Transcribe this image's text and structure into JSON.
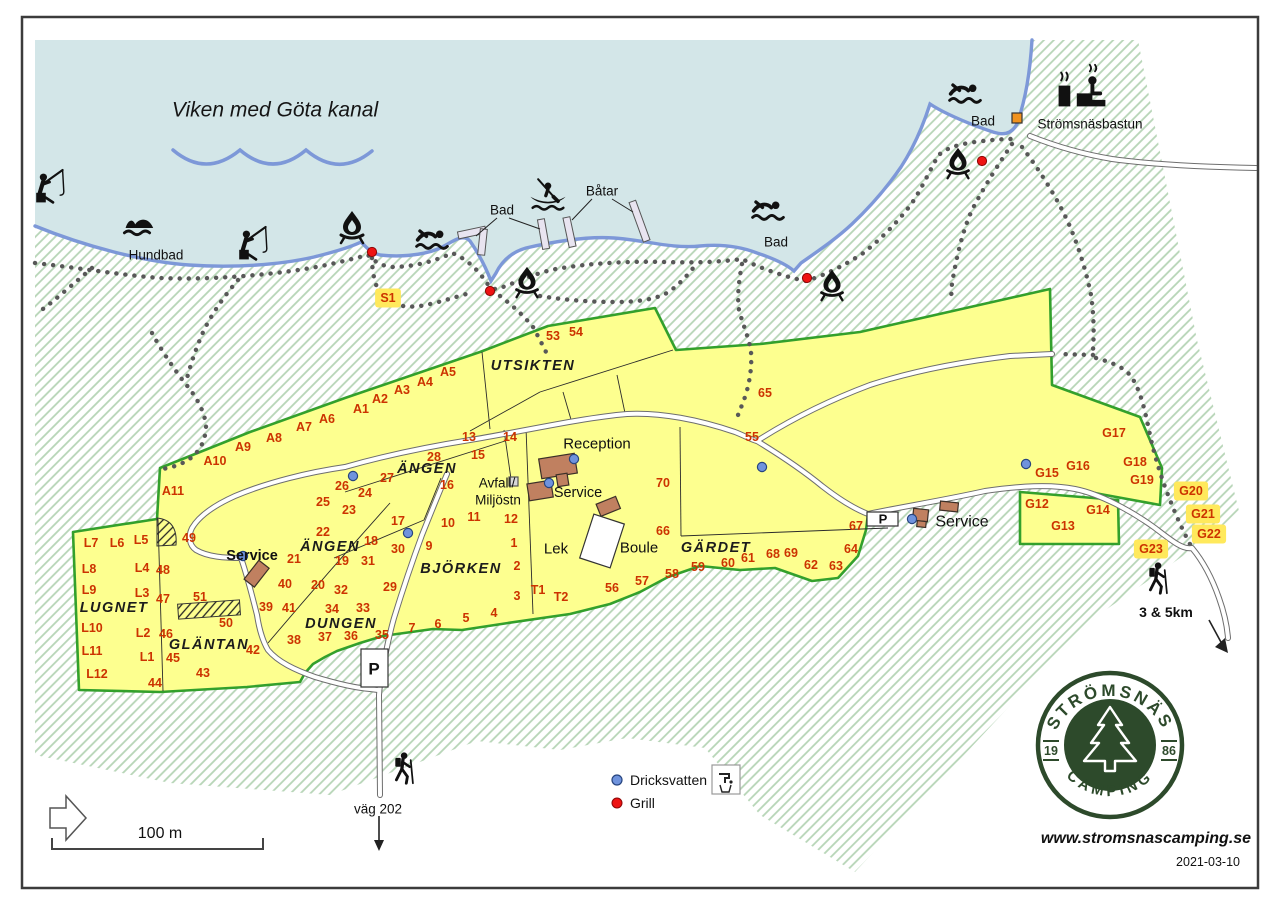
{
  "water": {
    "label": "Viken med Göta kanal"
  },
  "legend": {
    "drinking_water": "Dricksvatten",
    "grill": "Grill"
  },
  "footer": {
    "website": "www.stromsnascamping.se",
    "date": "2021-03-10",
    "scale_label": "100 m"
  },
  "logo": {
    "top": "STRÖMSNÄS",
    "bottom": "CAMPING",
    "year_left": "19",
    "year_right": "86"
  },
  "colors": {
    "water": "#d3e6e8",
    "shoreline": "#7d98d8",
    "camp_yellow": "#fdff8f",
    "camp_border": "#33a02c",
    "site_number": "#cc3300",
    "highlight_bg": "#ffe95c",
    "building": "#c08060",
    "bastun_orange": "#f0921e",
    "drinking_water_dot": "#6f93dd",
    "grill_dot": "#ee1313",
    "logo_green": "#2d4a2b",
    "land_hatch": "#b7d5b7"
  },
  "labels": {
    "sites": [
      {
        "t": "1",
        "x": 514,
        "y": 543
      },
      {
        "t": "2",
        "x": 517,
        "y": 566
      },
      {
        "t": "3",
        "x": 517,
        "y": 596
      },
      {
        "t": "4",
        "x": 494,
        "y": 613
      },
      {
        "t": "5",
        "x": 466,
        "y": 618
      },
      {
        "t": "6",
        "x": 438,
        "y": 624
      },
      {
        "t": "7",
        "x": 412,
        "y": 628
      },
      {
        "t": "9",
        "x": 429,
        "y": 546
      },
      {
        "t": "10",
        "x": 448,
        "y": 523
      },
      {
        "t": "11",
        "x": 474,
        "y": 517
      },
      {
        "t": "12",
        "x": 511,
        "y": 519
      },
      {
        "t": "13",
        "x": 469,
        "y": 437
      },
      {
        "t": "14",
        "x": 510,
        "y": 437
      },
      {
        "t": "15",
        "x": 478,
        "y": 455
      },
      {
        "t": "16",
        "x": 447,
        "y": 485
      },
      {
        "t": "17",
        "x": 398,
        "y": 521
      },
      {
        "t": "18",
        "x": 371,
        "y": 541
      },
      {
        "t": "19",
        "x": 342,
        "y": 561
      },
      {
        "t": "20",
        "x": 318,
        "y": 585
      },
      {
        "t": "21",
        "x": 294,
        "y": 559
      },
      {
        "t": "22",
        "x": 323,
        "y": 532
      },
      {
        "t": "23",
        "x": 349,
        "y": 510
      },
      {
        "t": "24",
        "x": 365,
        "y": 493
      },
      {
        "t": "25",
        "x": 323,
        "y": 502
      },
      {
        "t": "26",
        "x": 342,
        "y": 486
      },
      {
        "t": "27",
        "x": 387,
        "y": 478
      },
      {
        "t": "28",
        "x": 434,
        "y": 457
      },
      {
        "t": "29",
        "x": 390,
        "y": 587
      },
      {
        "t": "30",
        "x": 398,
        "y": 549
      },
      {
        "t": "31",
        "x": 368,
        "y": 561
      },
      {
        "t": "32",
        "x": 341,
        "y": 590
      },
      {
        "t": "33",
        "x": 363,
        "y": 608
      },
      {
        "t": "34",
        "x": 332,
        "y": 609
      },
      {
        "t": "35",
        "x": 382,
        "y": 635
      },
      {
        "t": "36",
        "x": 351,
        "y": 636
      },
      {
        "t": "37",
        "x": 325,
        "y": 637
      },
      {
        "t": "38",
        "x": 294,
        "y": 640
      },
      {
        "t": "39",
        "x": 266,
        "y": 607
      },
      {
        "t": "40",
        "x": 285,
        "y": 584
      },
      {
        "t": "41",
        "x": 289,
        "y": 608
      },
      {
        "t": "42",
        "x": 253,
        "y": 650
      },
      {
        "t": "43",
        "x": 203,
        "y": 673
      },
      {
        "t": "44",
        "x": 155,
        "y": 683
      },
      {
        "t": "45",
        "x": 173,
        "y": 658
      },
      {
        "t": "46",
        "x": 166,
        "y": 634
      },
      {
        "t": "47",
        "x": 163,
        "y": 599
      },
      {
        "t": "48",
        "x": 163,
        "y": 570
      },
      {
        "t": "49",
        "x": 189,
        "y": 538
      },
      {
        "t": "50",
        "x": 226,
        "y": 623
      },
      {
        "t": "51",
        "x": 200,
        "y": 597
      },
      {
        "t": "53",
        "x": 553,
        "y": 336
      },
      {
        "t": "54",
        "x": 576,
        "y": 332
      },
      {
        "t": "55",
        "x": 752,
        "y": 437
      },
      {
        "t": "56",
        "x": 612,
        "y": 588
      },
      {
        "t": "57",
        "x": 642,
        "y": 581
      },
      {
        "t": "58",
        "x": 672,
        "y": 574
      },
      {
        "t": "59",
        "x": 698,
        "y": 567
      },
      {
        "t": "60",
        "x": 728,
        "y": 563
      },
      {
        "t": "61",
        "x": 748,
        "y": 558
      },
      {
        "t": "62",
        "x": 811,
        "y": 565
      },
      {
        "t": "63",
        "x": 836,
        "y": 566
      },
      {
        "t": "64",
        "x": 851,
        "y": 549
      },
      {
        "t": "65",
        "x": 765,
        "y": 393
      },
      {
        "t": "66",
        "x": 663,
        "y": 531
      },
      {
        "t": "67",
        "x": 856,
        "y": 526
      },
      {
        "t": "68",
        "x": 773,
        "y": 554
      },
      {
        "t": "69",
        "x": 791,
        "y": 553
      },
      {
        "t": "70",
        "x": 663,
        "y": 483
      },
      {
        "t": "A1",
        "x": 361,
        "y": 409
      },
      {
        "t": "A2",
        "x": 380,
        "y": 399
      },
      {
        "t": "A3",
        "x": 402,
        "y": 390
      },
      {
        "t": "A4",
        "x": 425,
        "y": 382
      },
      {
        "t": "A5",
        "x": 448,
        "y": 372
      },
      {
        "t": "A6",
        "x": 327,
        "y": 419
      },
      {
        "t": "A7",
        "x": 304,
        "y": 427
      },
      {
        "t": "A8",
        "x": 274,
        "y": 438
      },
      {
        "t": "A9",
        "x": 243,
        "y": 447
      },
      {
        "t": "A10",
        "x": 215,
        "y": 461
      },
      {
        "t": "A11",
        "x": 173,
        "y": 491
      },
      {
        "t": "L1",
        "x": 147,
        "y": 657
      },
      {
        "t": "L2",
        "x": 143,
        "y": 633
      },
      {
        "t": "L3",
        "x": 142,
        "y": 593
      },
      {
        "t": "L4",
        "x": 142,
        "y": 568
      },
      {
        "t": "L5",
        "x": 141,
        "y": 540
      },
      {
        "t": "L6",
        "x": 117,
        "y": 543
      },
      {
        "t": "L7",
        "x": 91,
        "y": 543
      },
      {
        "t": "L8",
        "x": 89,
        "y": 569
      },
      {
        "t": "L9",
        "x": 89,
        "y": 590
      },
      {
        "t": "L10",
        "x": 92,
        "y": 628
      },
      {
        "t": "L11",
        "x": 92,
        "y": 651
      },
      {
        "t": "L12",
        "x": 97,
        "y": 674
      },
      {
        "t": "G12",
        "x": 1037,
        "y": 504
      },
      {
        "t": "G13",
        "x": 1063,
        "y": 526
      },
      {
        "t": "G14",
        "x": 1098,
        "y": 510
      },
      {
        "t": "G15",
        "x": 1047,
        "y": 473
      },
      {
        "t": "G16",
        "x": 1078,
        "y": 466
      },
      {
        "t": "G17",
        "x": 1114,
        "y": 433
      },
      {
        "t": "G18",
        "x": 1135,
        "y": 462
      },
      {
        "t": "G19",
        "x": 1142,
        "y": 480
      },
      {
        "t": "T1",
        "x": 538,
        "y": 590
      },
      {
        "t": "T2",
        "x": 561,
        "y": 597
      }
    ],
    "highlighted_sites": [
      {
        "t": "S1",
        "x": 388,
        "y": 298
      },
      {
        "t": "G20",
        "x": 1191,
        "y": 491
      },
      {
        "t": "G21",
        "x": 1203,
        "y": 514
      },
      {
        "t": "G22",
        "x": 1209,
        "y": 534
      },
      {
        "t": "G23",
        "x": 1151,
        "y": 549
      }
    ],
    "areas": [
      {
        "t": "UTSIKTEN",
        "x": 533,
        "y": 366
      },
      {
        "t": "ÄNGEN",
        "x": 427,
        "y": 469
      },
      {
        "t": "ÄNGEN",
        "x": 330,
        "y": 547
      },
      {
        "t": "LUGNET",
        "x": 114,
        "y": 608
      },
      {
        "t": "GLÄNTAN",
        "x": 209,
        "y": 645
      },
      {
        "t": "DUNGEN",
        "x": 341,
        "y": 624
      },
      {
        "t": "BJÖRKEN",
        "x": 461,
        "y": 569
      },
      {
        "t": "GÄRDET",
        "x": 716,
        "y": 548
      }
    ],
    "places": [
      {
        "t": "Reception",
        "x": 597,
        "y": 444,
        "fs": 15
      },
      {
        "t": "Service",
        "x": 578,
        "y": 493,
        "fs": 14.5
      },
      {
        "t": "Service",
        "x": 252,
        "y": 556,
        "fs": 14.5,
        "fw": 700
      },
      {
        "t": "Service",
        "x": 962,
        "y": 522,
        "fs": 16
      },
      {
        "t": "Avfall/",
        "x": 497,
        "y": 483,
        "fs": 13.5
      },
      {
        "t": "Miljöstn",
        "x": 498,
        "y": 500,
        "fs": 13.5
      },
      {
        "t": "Lek",
        "x": 556,
        "y": 549,
        "fs": 15
      },
      {
        "t": "Boule",
        "x": 639,
        "y": 548,
        "fs": 15
      },
      {
        "t": "Hundbad",
        "x": 156,
        "y": 255,
        "fs": 13.5
      },
      {
        "t": "Bad",
        "x": 502,
        "y": 210,
        "fs": 13.5
      },
      {
        "t": "Bad",
        "x": 776,
        "y": 242,
        "fs": 13.5
      },
      {
        "t": "Bad",
        "x": 983,
        "y": 121,
        "fs": 13.5
      },
      {
        "t": "Båtar",
        "x": 602,
        "y": 191,
        "fs": 13.5
      },
      {
        "t": "Strömsnäsbastun",
        "x": 1090,
        "y": 124,
        "fs": 13.5
      },
      {
        "t": "väg 202",
        "x": 378,
        "y": 809,
        "fs": 13.5
      },
      {
        "t": "3 & 5km",
        "x": 1166,
        "y": 612,
        "fs": 14,
        "fw": 700
      },
      {
        "t": "P",
        "x": 374,
        "y": 669,
        "fs": 17,
        "fw": 700
      },
      {
        "t": "P",
        "x": 883,
        "y": 519,
        "fs": 13,
        "fw": 700
      }
    ]
  },
  "markers": {
    "drinking_water": [
      {
        "x": 353,
        "y": 476
      },
      {
        "x": 408,
        "y": 533
      },
      {
        "x": 574,
        "y": 459
      },
      {
        "x": 549,
        "y": 483
      },
      {
        "x": 762,
        "y": 467
      },
      {
        "x": 1026,
        "y": 464
      },
      {
        "x": 912,
        "y": 519
      },
      {
        "x": 243,
        "y": 556
      }
    ],
    "grills": [
      {
        "x": 372,
        "y": 252
      },
      {
        "x": 490,
        "y": 291
      },
      {
        "x": 807,
        "y": 278
      },
      {
        "x": 982,
        "y": 161
      }
    ]
  },
  "icons": [
    {
      "name": "fisherman",
      "x": 47,
      "y": 194,
      "s": 1.2
    },
    {
      "name": "fisherman",
      "x": 250,
      "y": 251,
      "s": 1.2
    },
    {
      "name": "dogswim",
      "x": 140,
      "y": 228,
      "s": 1.2
    },
    {
      "name": "swimmer",
      "x": 432,
      "y": 242,
      "s": 1.1
    },
    {
      "name": "swimmer",
      "x": 768,
      "y": 213,
      "s": 1.1
    },
    {
      "name": "swimmer",
      "x": 965,
      "y": 96,
      "s": 1.1
    },
    {
      "name": "campfire",
      "x": 352,
      "y": 228,
      "s": 1.0
    },
    {
      "name": "campfire",
      "x": 527,
      "y": 283,
      "s": 0.95
    },
    {
      "name": "campfire",
      "x": 832,
      "y": 286,
      "s": 0.95
    },
    {
      "name": "campfire",
      "x": 958,
      "y": 164,
      "s": 0.95
    },
    {
      "name": "canoe",
      "x": 548,
      "y": 199,
      "s": 1.1
    },
    {
      "name": "sauna",
      "x": 1082,
      "y": 96,
      "s": 1.3
    },
    {
      "name": "hiker",
      "x": 403,
      "y": 770,
      "s": 1.1
    },
    {
      "name": "hiker",
      "x": 1157,
      "y": 580,
      "s": 1.1
    }
  ]
}
